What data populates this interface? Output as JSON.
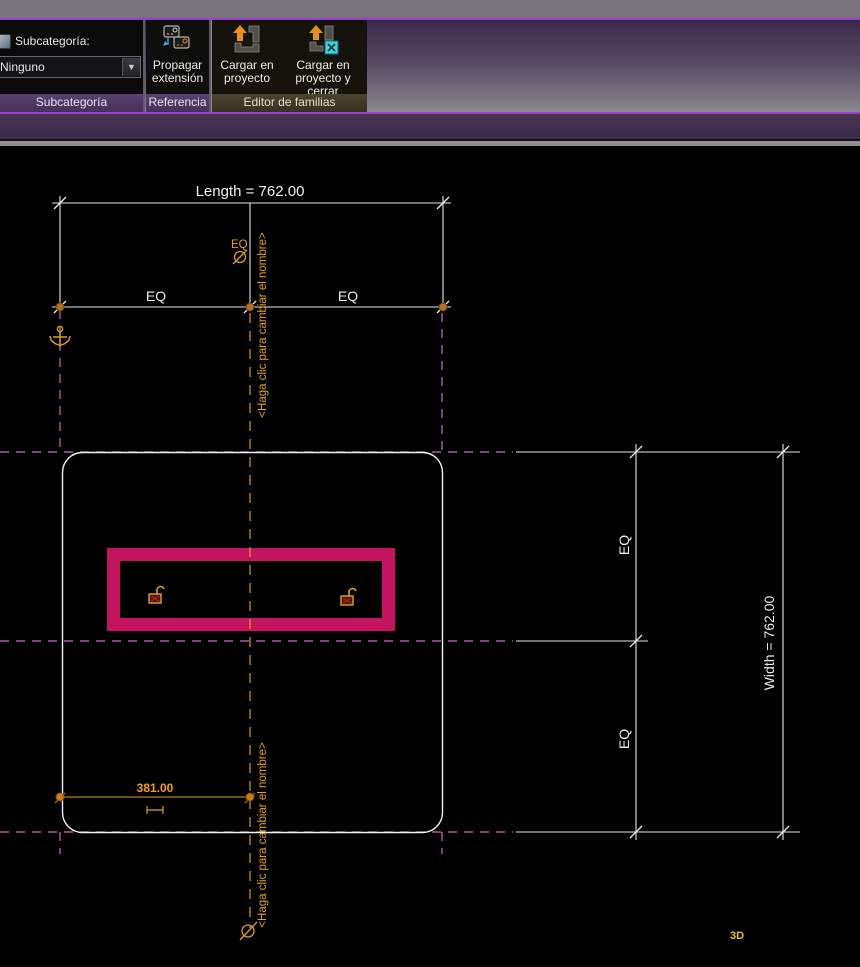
{
  "ribbon": {
    "subcategory": {
      "label": "Subcategoría:",
      "value": "Ninguno"
    },
    "propagate": {
      "line1": "Propagar",
      "line2": "extensión"
    },
    "load_project": {
      "line1": "Cargar en",
      "line2": "proyecto"
    },
    "load_project_close": {
      "line1": "Cargar en",
      "line2": "proyecto y cerrar"
    },
    "captions": {
      "subcategoria": "Subcategoría",
      "referencia": "Referencia",
      "editor": "Editor de familias"
    }
  },
  "canvas": {
    "length_dim": "Length = 762.00",
    "width_dim": "Width = 762.00",
    "eq_label": "EQ",
    "dim_381": "381.00",
    "ref_plane_name": "<Haga clic para cambiar el nombre>",
    "view_label_3d": "3D",
    "colors": {
      "canvas_bg": "#000000",
      "dimension_white": "#f0f0f0",
      "ref_plane_magenta": "#cc6ccc",
      "selected_gold": "#d8a018",
      "sketch_selection_pink": "#c4145e",
      "accent_purple": "#9d3fd4",
      "view3d_yellow": "#e8c23a"
    }
  }
}
